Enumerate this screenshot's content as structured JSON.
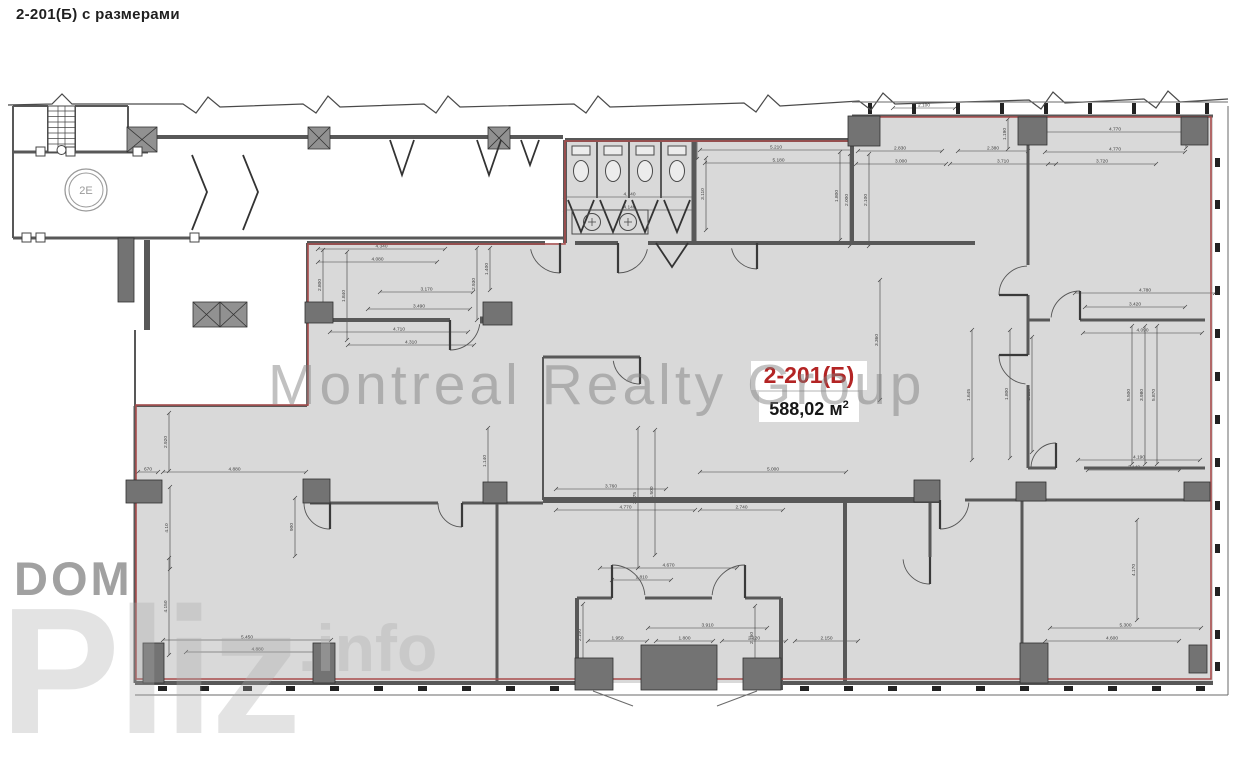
{
  "page": {
    "title": "2-201(Б) с размерами"
  },
  "unit": {
    "code": "2-201(Б)",
    "area_value": "588,02",
    "area_unit": "м",
    "area_exp": "2"
  },
  "labels": {
    "elevator": "2E"
  },
  "watermarks": {
    "main": "Montreal Realty Group",
    "dom": "DOM",
    "pliz": "Pliz",
    "info": ".info"
  },
  "colors": {
    "floor": "#d9d9d9",
    "wall": "#585858",
    "thin": "#6a6a6a",
    "column": "#737373",
    "boundary": "#a94c4c",
    "dim": "#3c3c3c",
    "accent_red": "#b32424",
    "fixture": "#4a4a4a"
  },
  "plan": {
    "unit_polygon": "563,140 852,140 852,116 1213,116 1213,683 135,683 135,404 307,404 307,243 563,243",
    "red_polygon": "565,141 852,141 852,117 1211,117 1211,679 136,679 136,405 308,405 308,244 565,244",
    "walls": [
      [
        13,
        106,
        13,
        238,
        2
      ],
      [
        13,
        106,
        48,
        106,
        2
      ],
      [
        75,
        106,
        128,
        106,
        2
      ],
      [
        128,
        106,
        128,
        137,
        2
      ],
      [
        13,
        152,
        148,
        152,
        3
      ],
      [
        48,
        106,
        48,
        152,
        2
      ],
      [
        75,
        106,
        75,
        152,
        2
      ],
      [
        13,
        238,
        563,
        238,
        3
      ],
      [
        128,
        137,
        563,
        137,
        4
      ],
      [
        147,
        240,
        147,
        330,
        6
      ],
      [
        135,
        330,
        135,
        406,
        2
      ],
      [
        565,
        140,
        852,
        140,
        4
      ],
      [
        852,
        116,
        1213,
        116,
        3
      ],
      [
        307,
        243,
        545,
        243,
        4
      ],
      [
        575,
        243,
        618,
        243,
        4
      ],
      [
        648,
        243,
        975,
        243,
        4
      ],
      [
        330,
        320,
        450,
        320,
        4
      ],
      [
        480,
        320,
        512,
        320,
        7
      ],
      [
        543,
        357,
        640,
        357,
        3
      ],
      [
        543,
        500,
        940,
        500,
        6
      ],
      [
        310,
        503,
        438,
        503,
        3
      ],
      [
        462,
        503,
        543,
        503,
        3
      ],
      [
        965,
        500,
        1210,
        500,
        3
      ],
      [
        1028,
        320,
        1050,
        320,
        3
      ],
      [
        1080,
        320,
        1205,
        320,
        3
      ],
      [
        1028,
        468,
        1056,
        468,
        3
      ],
      [
        1084,
        468,
        1205,
        468,
        3
      ],
      [
        135,
        683,
        577,
        683,
        4
      ],
      [
        781,
        683,
        1213,
        683,
        4
      ],
      [
        135,
        406,
        307,
        406,
        2
      ],
      [
        577,
        598,
        612,
        598,
        3
      ],
      [
        645,
        598,
        712,
        598,
        3
      ],
      [
        745,
        598,
        781,
        598,
        3
      ],
      [
        565,
        140,
        565,
        243,
        4
      ],
      [
        694,
        140,
        694,
        243,
        5
      ],
      [
        852,
        140,
        852,
        243,
        4
      ],
      [
        1028,
        145,
        1028,
        265,
        3
      ],
      [
        1028,
        295,
        1028,
        355,
        3
      ],
      [
        1028,
        385,
        1028,
        468,
        3
      ],
      [
        497,
        503,
        497,
        683,
        3
      ],
      [
        845,
        500,
        845,
        683,
        4
      ],
      [
        930,
        500,
        930,
        557,
        3
      ],
      [
        1022,
        500,
        1022,
        683,
        3
      ],
      [
        135,
        406,
        135,
        683,
        3
      ],
      [
        577,
        598,
        577,
        690,
        4
      ],
      [
        781,
        598,
        781,
        690,
        4
      ],
      [
        543,
        357,
        543,
        500,
        2
      ],
      [
        597,
        140,
        597,
        198,
        2
      ],
      [
        629,
        140,
        629,
        198,
        2
      ],
      [
        661,
        140,
        661,
        198,
        2
      ],
      [
        307,
        243,
        307,
        406,
        2
      ]
    ],
    "columns": [
      [
        848,
        116,
        32,
        30
      ],
      [
        1018,
        117,
        29,
        28
      ],
      [
        1181,
        117,
        27,
        28
      ],
      [
        126,
        480,
        36,
        23
      ],
      [
        303,
        479,
        27,
        24
      ],
      [
        483,
        482,
        24,
        21
      ],
      [
        914,
        480,
        26,
        22
      ],
      [
        1016,
        482,
        30,
        19
      ],
      [
        1184,
        482,
        26,
        19
      ],
      [
        143,
        643,
        21,
        40
      ],
      [
        313,
        643,
        22,
        40
      ],
      [
        1020,
        643,
        28,
        40
      ],
      [
        1189,
        645,
        18,
        28
      ],
      [
        575,
        658,
        38,
        32
      ],
      [
        743,
        658,
        38,
        32
      ],
      [
        641,
        645,
        76,
        45
      ],
      [
        305,
        302,
        28,
        21
      ],
      [
        483,
        302,
        29,
        23
      ],
      [
        118,
        238,
        16,
        64
      ]
    ],
    "crossed": [
      [
        308,
        127,
        22,
        22
      ],
      [
        488,
        127,
        22,
        22
      ],
      [
        127,
        127,
        30,
        25
      ],
      [
        193,
        302,
        27,
        25
      ],
      [
        220,
        302,
        27,
        25
      ]
    ],
    "doors": [
      [
        560,
        243,
        30,
        90,
        168
      ],
      [
        618,
        243,
        30,
        90,
        12
      ],
      [
        757,
        243,
        26,
        90,
        168
      ],
      [
        450,
        320,
        30,
        90,
        8
      ],
      [
        640,
        357,
        27,
        90,
        172
      ],
      [
        330,
        503,
        26,
        90,
        180
      ],
      [
        462,
        503,
        24,
        90,
        180
      ],
      [
        940,
        500,
        29,
        90,
        5
      ],
      [
        612,
        598,
        33,
        270,
        355
      ],
      [
        745,
        598,
        33,
        270,
        185
      ],
      [
        1080,
        320,
        29,
        270,
        185
      ],
      [
        1028,
        355,
        29,
        180,
        95
      ],
      [
        1028,
        295,
        29,
        180,
        268
      ],
      [
        930,
        557,
        27,
        90,
        175
      ],
      [
        1056,
        468,
        25,
        270,
        182
      ]
    ],
    "chevrons": [
      [
        [
          192,
          155
        ],
        [
          207,
          192
        ],
        [
          192,
          230
        ]
      ],
      [
        [
          243,
          155
        ],
        [
          258,
          192
        ],
        [
          243,
          230
        ]
      ],
      [
        [
          390,
          140
        ],
        [
          402,
          175
        ],
        [
          414,
          140
        ]
      ],
      [
        [
          477,
          140
        ],
        [
          489,
          175
        ],
        [
          501,
          140
        ]
      ],
      [
        [
          521,
          140
        ],
        [
          530,
          165
        ],
        [
          539,
          140
        ]
      ],
      [
        [
          656,
          243
        ],
        [
          672,
          267
        ],
        [
          688,
          243
        ]
      ],
      [
        [
          568,
          200
        ],
        [
          581,
          232
        ],
        [
          594,
          200
        ]
      ],
      [
        [
          600,
          200
        ],
        [
          613,
          232
        ],
        [
          626,
          200
        ]
      ],
      [
        [
          632,
          200
        ],
        [
          645,
          232
        ],
        [
          658,
          200
        ]
      ],
      [
        [
          664,
          200
        ],
        [
          677,
          232
        ],
        [
          690,
          200
        ]
      ]
    ],
    "squares": [
      [
        36,
        233
      ],
      [
        190,
        233
      ],
      [
        36,
        147
      ],
      [
        66,
        147
      ],
      [
        133,
        147
      ],
      [
        22,
        233
      ]
    ],
    "zigzag": "8,105 52,104 62,94 72,104 183,104 196,113 208,97 220,107 303,104 316,113 328,96 340,107 424,104 436,113 448,96 460,107 574,104 586,113 598,96 610,107 744,103 756,112 768,95 780,106 859,101 871,110 883,93 895,104 1029,100 1041,109 1053,92 1065,103 1144,99 1156,108 1168,91 1180,102 1228,99",
    "outline": [
      [
        1228,
        106,
        1228,
        695
      ],
      [
        135,
        695,
        1228,
        695
      ],
      [
        852,
        102,
        1228,
        102
      ],
      [
        593,
        691,
        633,
        706
      ],
      [
        757,
        691,
        717,
        706
      ]
    ],
    "ticks_right": {
      "x": 1215,
      "w": 5,
      "h": 9,
      "ys": [
        158,
        200,
        243,
        286,
        329,
        372,
        415,
        458,
        501,
        544,
        587,
        630,
        662
      ]
    },
    "ticks_bottom": {
      "y": 686,
      "w": 9,
      "h": 5,
      "xs": [
        158,
        200,
        243,
        286,
        330,
        374,
        418,
        462,
        506,
        550,
        800,
        844,
        888,
        932,
        976,
        1020,
        1064,
        1108,
        1152,
        1196
      ]
    },
    "ticks_top": {
      "y": 103,
      "w": 4,
      "h": 11,
      "xs": [
        868,
        912,
        956,
        1000,
        1044,
        1088,
        1132,
        1176,
        1205
      ]
    },
    "dims_h": [
      [
        565,
        197,
        129,
        "4.140"
      ],
      [
        565,
        210,
        129,
        "4.140"
      ],
      [
        700,
        150,
        152,
        "5.210"
      ],
      [
        705,
        163,
        147,
        "5.180"
      ],
      [
        1045,
        132,
        140,
        "4.770"
      ],
      [
        1045,
        152,
        140,
        "4.770"
      ],
      [
        1048,
        164,
        108,
        "3.720"
      ],
      [
        858,
        151,
        84,
        "2.830"
      ],
      [
        856,
        164,
        90,
        "3.000"
      ],
      [
        958,
        151,
        70,
        "2.380"
      ],
      [
        950,
        164,
        106,
        "3.710"
      ],
      [
        893,
        108,
        62,
        "2.100"
      ],
      [
        318,
        249,
        127,
        "4.340"
      ],
      [
        318,
        262,
        119,
        "4.080"
      ],
      [
        380,
        292,
        93,
        "3.170"
      ],
      [
        368,
        309,
        102,
        "3.490"
      ],
      [
        330,
        332,
        138,
        "4.710"
      ],
      [
        348,
        345,
        126,
        "4.310"
      ],
      [
        163,
        472,
        143,
        "4.880"
      ],
      [
        138,
        472,
        20,
        "670"
      ],
      [
        556,
        489,
        110,
        "3.760"
      ],
      [
        556,
        510,
        139,
        "4.770"
      ],
      [
        700,
        472,
        146,
        "5.000"
      ],
      [
        1075,
        293,
        140,
        "4.780"
      ],
      [
        1085,
        307,
        100,
        "3.420"
      ],
      [
        1083,
        333,
        119,
        "4.090"
      ],
      [
        1078,
        460,
        122,
        "4.190"
      ],
      [
        1088,
        470,
        92,
        "3.140"
      ],
      [
        1050,
        628,
        151,
        "5.300"
      ],
      [
        1045,
        641,
        134,
        "4.600"
      ],
      [
        600,
        568,
        137,
        "4.670"
      ],
      [
        612,
        580,
        59,
        "1.810"
      ],
      [
        648,
        628,
        119,
        "3.910"
      ],
      [
        588,
        641,
        59,
        "1.950"
      ],
      [
        656,
        641,
        57,
        "1.800"
      ],
      [
        722,
        641,
        64,
        "2.120"
      ],
      [
        795,
        641,
        63,
        "2.150"
      ],
      [
        163,
        640,
        168,
        "5.450"
      ],
      [
        186,
        652,
        143,
        "4.880"
      ],
      [
        700,
        510,
        83,
        "2.740"
      ]
    ],
    "dims_v": [
      [
        323,
        250,
        70,
        "2.800"
      ],
      [
        347,
        252,
        88,
        "1.840"
      ],
      [
        477,
        248,
        72,
        "2.930"
      ],
      [
        490,
        248,
        42,
        "1.400"
      ],
      [
        840,
        152,
        88,
        "1.800"
      ],
      [
        850,
        154,
        92,
        "2.000"
      ],
      [
        869,
        154,
        92,
        "2.100"
      ],
      [
        1008,
        119,
        30,
        "1.190"
      ],
      [
        1186,
        120,
        28,
        "990"
      ],
      [
        972,
        330,
        130,
        "1.645"
      ],
      [
        1010,
        330,
        128,
        "1.800"
      ],
      [
        1032,
        337,
        115,
        "2.125"
      ],
      [
        1132,
        326,
        138,
        "5.500"
      ],
      [
        1145,
        326,
        138,
        "3.980"
      ],
      [
        1157,
        326,
        138,
        "5.870"
      ],
      [
        169,
        413,
        58,
        "2.920"
      ],
      [
        170,
        487,
        82,
        "4.10"
      ],
      [
        169,
        558,
        97,
        "4.150"
      ],
      [
        706,
        158,
        72,
        "3.110"
      ],
      [
        697,
        141,
        18,
        "180"
      ],
      [
        583,
        604,
        62,
        "2.100"
      ],
      [
        755,
        606,
        64,
        "2.160"
      ],
      [
        295,
        498,
        58,
        "900"
      ],
      [
        488,
        428,
        66,
        "1.140"
      ],
      [
        638,
        428,
        140,
        "2.075"
      ],
      [
        655,
        430,
        125,
        "1.500"
      ],
      [
        880,
        280,
        120,
        "3.360"
      ],
      [
        1137,
        520,
        100,
        "4.170"
      ]
    ],
    "toilets": {
      "cxs": [
        581,
        613,
        645,
        677
      ],
      "cy": 171
    },
    "sink": {
      "x": 572,
      "y": 210,
      "w": 76,
      "h": 24,
      "taps": [
        592,
        628
      ],
      "cy": 222
    },
    "stairs": {
      "x": 48,
      "y": 106,
      "w": 27,
      "h": 46
    },
    "elevator": {
      "cx": 86,
      "cy": 190,
      "r1": 21,
      "r2": 17
    }
  }
}
